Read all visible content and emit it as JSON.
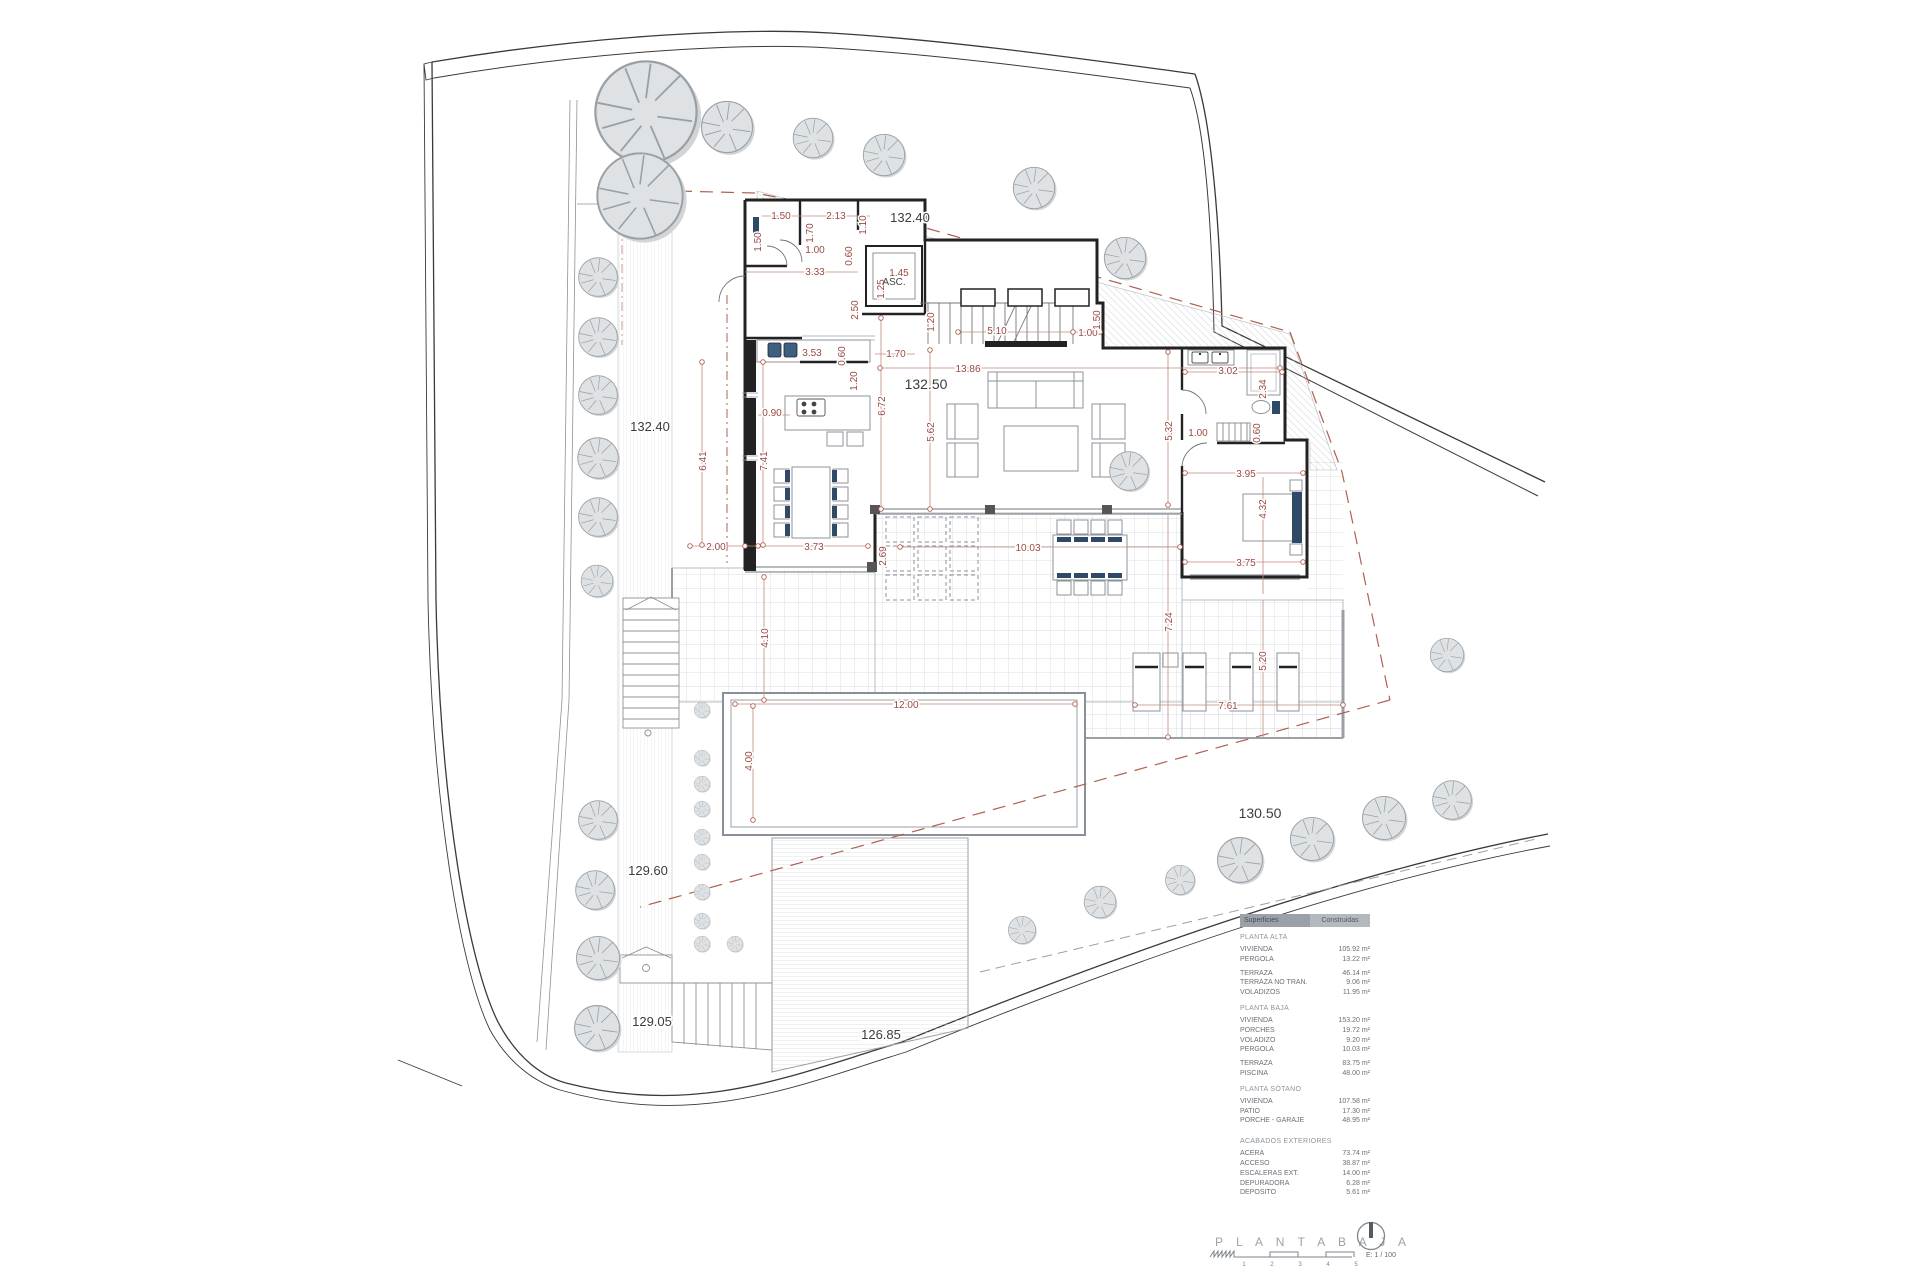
{
  "title_block": {
    "title": "P L A N T A  B A J A",
    "scale_label": "E: 1 / 100",
    "scale_ticks": [
      "1",
      "2",
      "3",
      "4",
      "5"
    ]
  },
  "rooms": {
    "elevator": "ASC."
  },
  "elevations": {
    "top_right": "132.40",
    "left": "132.40",
    "main_floor": "132.50",
    "lower_right": "130.50",
    "mid_left": "129.60",
    "bottom_left": "129.05",
    "bottom_center": "126.85"
  },
  "dimensions": [
    "1.50",
    "2.13",
    "1.10",
    "1.50",
    "1.70",
    "1.00",
    "0.60",
    "3.33",
    "1.45",
    "1.25",
    "2.50",
    "1.70",
    "3.53",
    "0.60",
    "1.20",
    "1.20",
    "5.10",
    "1.00",
    "1.50",
    "13.86",
    "0.90",
    "6.72",
    "5.62",
    "6.41",
    "7.41",
    "3.02",
    "2.34",
    "5.32",
    "1.00",
    "0.60",
    "3.95",
    "4.32",
    "3.75",
    "2.00",
    "3.73",
    "2.69",
    "10.03",
    "7.24",
    "5.20",
    "7.61",
    "12.00",
    "4.00",
    "4.10"
  ],
  "areas_table": {
    "header": {
      "col1": "Superficies",
      "col2": "Construidas"
    },
    "sections": [
      {
        "title": "PLANTA ALTA",
        "rows": [
          {
            "label": "VIVIENDA",
            "value": "105.92 m²"
          },
          {
            "label": "PERGOLA",
            "value": "13.22 m²"
          },
          {
            "label": "TERRAZA",
            "value": "46.14 m²"
          },
          {
            "label": "TERRAZA NO TRAN.",
            "value": "9.06 m²"
          },
          {
            "label": "VOLADIZOS",
            "value": "11.95 m²"
          }
        ]
      },
      {
        "title": "PLANTA BAJA",
        "rows": [
          {
            "label": "VIVIENDA",
            "value": "153.20 m²"
          },
          {
            "label": "PORCHES",
            "value": "19.72 m²"
          },
          {
            "label": "VOLADIZO",
            "value": "9.20 m²"
          },
          {
            "label": "PERGOLA",
            "value": "10.03 m²"
          },
          {
            "label": "TERRAZA",
            "value": "83.75 m²"
          },
          {
            "label": "PISCINA",
            "value": "48.00 m²"
          }
        ]
      },
      {
        "title": "PLANTA SÓTANO",
        "rows": [
          {
            "label": "VIVIENDA",
            "value": "107.58 m²"
          },
          {
            "label": "PATIO",
            "value": "17.30 m²"
          },
          {
            "label": "PORCHE - GARAJE",
            "value": "48.95 m²"
          }
        ]
      },
      {
        "title": "ACABADOS EXTERIORES",
        "rows": [
          {
            "label": "ACERA",
            "value": "73.74 m²"
          },
          {
            "label": "ACCESO",
            "value": "38.87 m²"
          },
          {
            "label": "ESCALERAS EXT.",
            "value": "14.00 m²"
          },
          {
            "label": "DEPURADORA",
            "value": "6.28 m²"
          },
          {
            "label": "DEPOSITO",
            "value": "5.61 m²"
          }
        ]
      }
    ]
  },
  "colors": {
    "dim_red": "#9a4a42",
    "setback_red": "#b06050",
    "wall_black": "#222222",
    "navy_accent": "#2e4a66",
    "tree_fill": "#dfe2e4",
    "header_gray": "#a9afb5"
  }
}
